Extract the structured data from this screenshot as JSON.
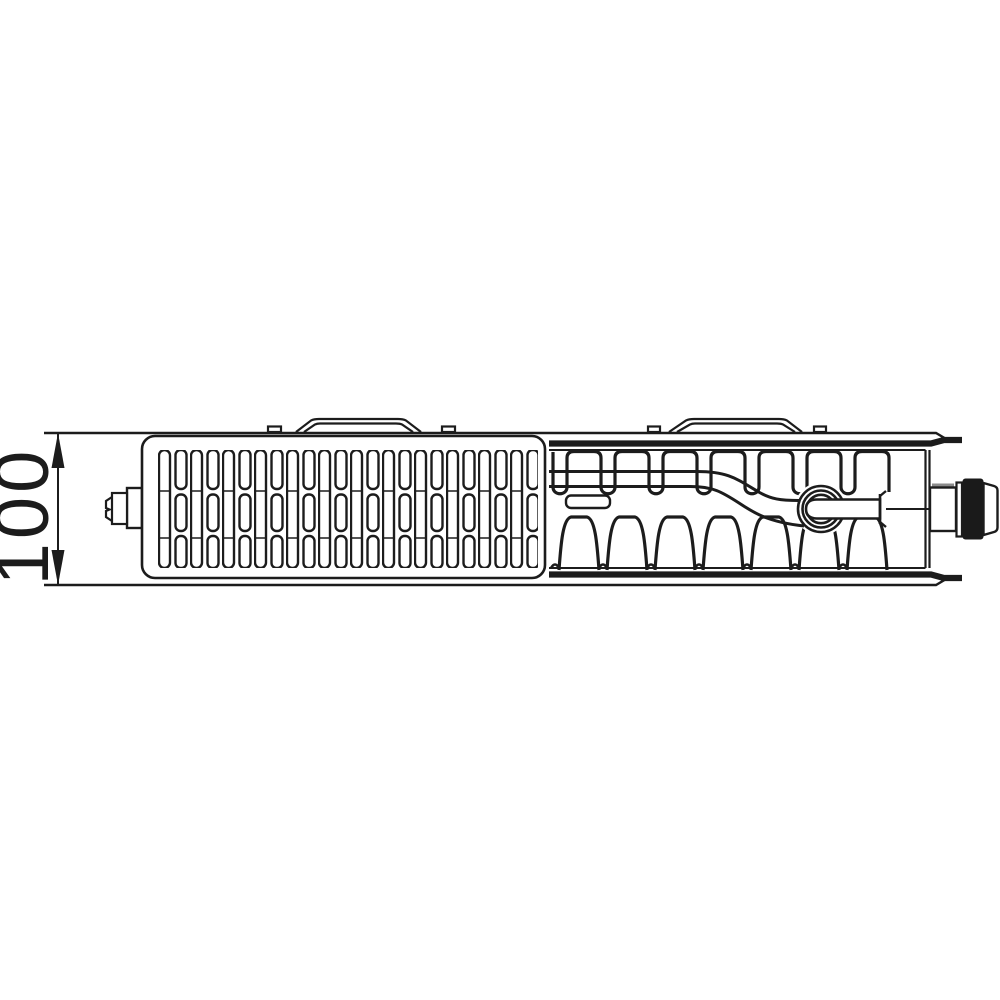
{
  "diagram": {
    "type": "technical-drawing",
    "subject": "panel-radiator-top-view-cross-section",
    "dimension_label": "100",
    "colors": {
      "line": "#1c1c1c",
      "background": "#ffffff",
      "valve_grip_fill": "#1a1a1a",
      "knurl_gray": "#8b8b8b"
    },
    "parts": [
      "dimension-annotation",
      "grille-panel",
      "vent-plug",
      "mounting-bracket-left",
      "mounting-bracket-right",
      "convector-fins",
      "supply-pipe",
      "valve-insert",
      "connection-tube",
      "thermostatic-valve-connection"
    ]
  }
}
